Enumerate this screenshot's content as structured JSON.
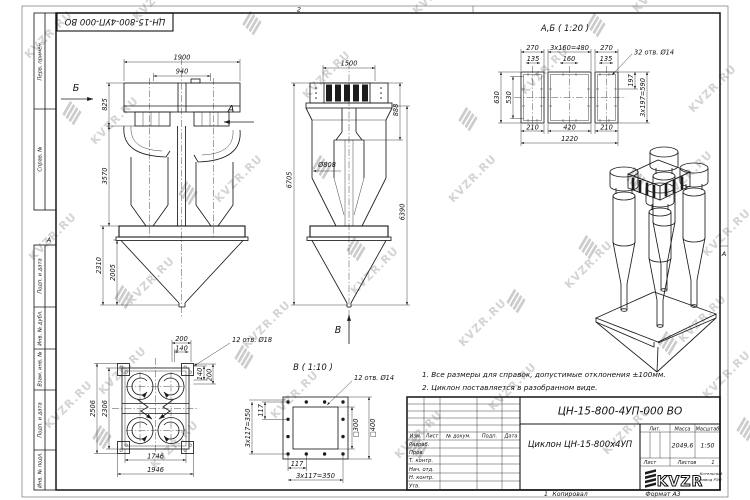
{
  "sheet": {
    "zone_top": "2",
    "zone_left": "А",
    "zone_right": "А",
    "top_stamp": "ЦН-15-800-4УП-000 ВО",
    "sidebar_labels": [
      "Перв. примен.",
      "Справ. №",
      "Подп. и дата",
      "Инв. № дубл.",
      "Взам. инв. №",
      "Подп. и дата",
      "Инв. № подл."
    ],
    "footer_mark": "1",
    "footer_copied": "Копировал",
    "footer_format": "Формат А3"
  },
  "watermarks": {
    "text": "KVZR.RU",
    "text_color": "#d4d4d4",
    "logo_color": "#cccccc",
    "text_positions": [
      [
        130,
        14
      ],
      [
        410,
        8
      ],
      [
        630,
        6
      ],
      [
        22,
        52
      ],
      [
        300,
        92
      ],
      [
        518,
        88
      ],
      [
        686,
        106
      ],
      [
        88,
        138
      ],
      [
        212,
        196
      ],
      [
        446,
        196
      ],
      [
        662,
        192
      ],
      [
        26,
        254
      ],
      [
        124,
        298
      ],
      [
        348,
        288
      ],
      [
        562,
        282
      ],
      [
        700,
        250
      ],
      [
        240,
        342
      ],
      [
        456,
        340
      ],
      [
        676,
        336
      ],
      [
        96,
        388
      ],
      [
        42,
        422
      ],
      [
        268,
        412
      ],
      [
        486,
        404
      ],
      [
        700,
        392
      ],
      [
        148,
        462
      ],
      [
        392,
        452
      ],
      [
        600,
        448
      ]
    ],
    "logo_positions": [
      [
        236,
        22
      ],
      [
        580,
        24
      ],
      [
        56,
        112
      ],
      [
        452,
        118
      ],
      [
        172,
        192
      ],
      [
        620,
        178
      ],
      [
        108,
        296
      ],
      [
        340,
        248
      ],
      [
        572,
        246
      ],
      [
        228,
        356
      ],
      [
        652,
        342
      ],
      [
        86,
        436
      ],
      [
        402,
        446
      ],
      [
        730,
        428
      ],
      [
        306,
        166
      ],
      [
        500,
        300
      ]
    ]
  },
  "notes": [
    "1. Все размеры для справок, допустимые отклонения ±100мм.",
    "2. Циклон поставляется в разобранном виде."
  ],
  "views": {
    "front": {
      "label_left": "Б",
      "label_right": "А",
      "dim_width_total": "1900",
      "dim_width_inner": "940",
      "dim_h_top": "825",
      "dim_h_mid": "3570",
      "dim_h_hopper": "2310",
      "dim_h_cone": "2005"
    },
    "side": {
      "label_bottom": "В",
      "dim_width": "1500",
      "dim_h_inlet": "888",
      "dim_diameter": "Ø808",
      "dim_h_total": "6705",
      "dim_h_right": "6390"
    },
    "section_ab": {
      "title": "А,Б ( 1:20 )",
      "holes_note": "32 отв. Ø14",
      "dim_270_left": "270",
      "dim_480": "3x160=480",
      "dim_270_right": "270",
      "dim_135_left": "135",
      "dim_160": "160",
      "dim_135_right": "135",
      "dim_630": "630",
      "dim_530": "530",
      "dim_197": "197",
      "dim_590": "3x197=590",
      "dim_210_left": "210",
      "dim_420": "420",
      "dim_210_right": "210",
      "dim_1220": "1220"
    },
    "plan": {
      "holes_note": "12 отв. Ø18",
      "dim_200_top": "200",
      "dim_140_top": "140",
      "dim_140_right": "140",
      "dim_200_right": "200",
      "dim_2506": "2506",
      "dim_2306": "2306",
      "dim_1746": "1746",
      "dim_1946": "1946"
    },
    "section_v": {
      "title": "В ( 1:10 )",
      "holes_note": "12 отв. Ø14",
      "dim_117_left": "117",
      "dim_350_left": "3x117=350",
      "dim_117_bottom": "117",
      "dim_350_bottom": "3x117=350",
      "dim_sq300": "□300",
      "dim_sq400": "□400"
    }
  },
  "title_block": {
    "doc_number": "ЦН-15-800-4УП-000 ВО",
    "product_name": "Циклон ЦН-15-800x4УП",
    "header_cols": [
      "Изм.",
      "Лист",
      "№ докум.",
      "Подп.",
      "Дата"
    ],
    "row_labels": [
      "Разраб.",
      "Пров.",
      "Т. контр.",
      "Нач. отд.",
      "Н. контр.",
      "Утв."
    ],
    "lit_label": "Лит.",
    "mass_label": "Масса",
    "scale_label": "Масштаб",
    "mass_value": "2049,6",
    "scale_value": "1:50",
    "sheet_label": "Лист",
    "sheets_label": "Листов",
    "sheets_value": "1",
    "logo_text": "KVZR",
    "company_line1": "Котельный",
    "company_line2": "завод РЭП"
  }
}
